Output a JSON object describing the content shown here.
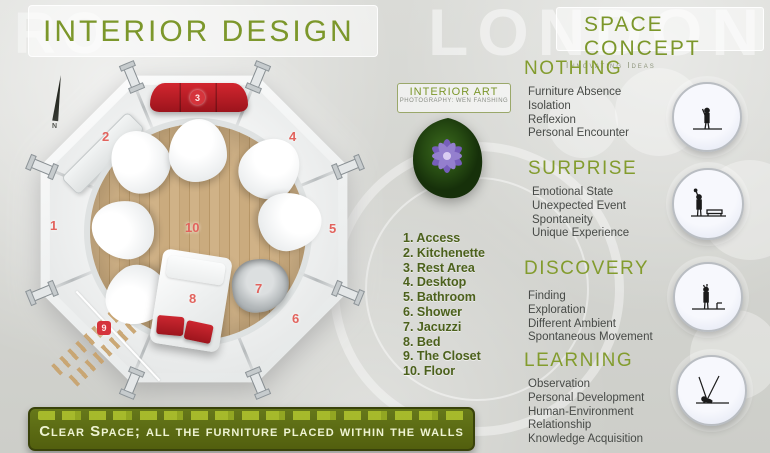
{
  "watermarks": {
    "left": "RO",
    "right": "LONDON"
  },
  "header": {
    "title": "INTERIOR DESIGN"
  },
  "plan": {
    "compass_label": "N",
    "labels": [
      "1",
      "2",
      "3",
      "4",
      "5",
      "6",
      "7",
      "8",
      "9",
      "10"
    ]
  },
  "interior_art": {
    "title": "INTERIOR ART",
    "credit": "PHOTOGRAPHY: WEN FANSHING"
  },
  "legend": {
    "items": [
      "1. Access",
      "2. Kitchenette",
      "3. Rest Area",
      "4. Desktop",
      "5. Bathroom",
      "6. Shower",
      "7. Jacuzzi",
      "8. Bed",
      "9. The Closet",
      "10. Floor"
    ]
  },
  "space_concept": {
    "title": "SPACE CONCEPT",
    "subtitle": "Innovating Ideas",
    "sections": [
      {
        "title": "NOTHING",
        "icon": "person-alone-icon",
        "items": [
          "Furniture Absence",
          "Isolation",
          "Reflexion",
          "Personal Encounter"
        ]
      },
      {
        "title": "SURPRISE",
        "icon": "person-with-bench-icon",
        "items": [
          "Emotional State",
          "Unexpected Event",
          "Spontaneity",
          "Unique Experience"
        ]
      },
      {
        "title": "DISCOVERY",
        "icon": "person-exploring-icon",
        "items": [
          "Finding",
          "Exploration",
          "Different Ambient",
          "Spontaneous Movement"
        ]
      },
      {
        "title": "LEARNING",
        "icon": "person-observing-rays-icon",
        "items": [
          "Observation",
          "Personal Development",
          "Human-Environment Relationship",
          "Knowledge Acquisition"
        ]
      }
    ]
  },
  "banner": {
    "text": "Clear Space; all the furniture placed within the walls"
  },
  "colors": {
    "accent_green": "#7c972b",
    "legend_green": "#4c611c",
    "banner_green": "#525f0e",
    "sofa_red": "#b9202a",
    "number_red": "#e2635d",
    "wood": "#caab7e",
    "flower_purple": "#7b5fc4"
  }
}
